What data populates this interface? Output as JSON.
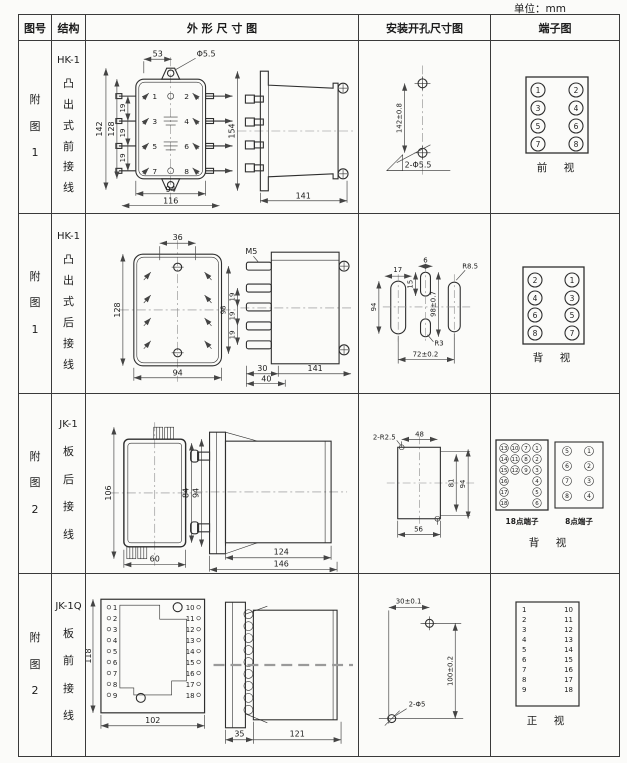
{
  "unit_label": "单位：mm",
  "header": {
    "fig": "图号",
    "struct": "结构",
    "outline": "外 形 尺 寸 图",
    "mount": "安装开孔尺寸图",
    "terminal": "端子图"
  },
  "rows": [
    {
      "fig_no": "附图1",
      "model": "HK-1",
      "structure": "凸出式前接线",
      "front": {
        "d53": "53",
        "dhole": "Φ5.5",
        "d142": "142",
        "d128": "128",
        "p1": "19",
        "p2": "19",
        "p3": "19",
        "d94": "94",
        "d116": "116",
        "t": [
          "1",
          "2",
          "3",
          "4",
          "5",
          "6",
          "7",
          "8"
        ]
      },
      "side": {
        "d154": "154",
        "d141": "141"
      },
      "mount": {
        "dv": "142±0.8",
        "holes": "2-Φ5.5"
      },
      "terminal": {
        "t": [
          "1",
          "2",
          "3",
          "4",
          "5",
          "6",
          "7",
          "8"
        ],
        "view": "前　视"
      }
    },
    {
      "fig_no": "附图1",
      "model": "HK-1",
      "structure": "凸出式后接线",
      "front": {
        "d36": "36",
        "d128": "128",
        "d94": "94"
      },
      "side": {
        "m5": "M5",
        "p1": "19",
        "p2": "19",
        "p3": "19",
        "d98": "98",
        "d30": "30",
        "d40": "40",
        "d141": "141"
      },
      "mount": {
        "d17": "17",
        "d6": "6",
        "d15": "15",
        "d94": "94",
        "dv": "98±0.7",
        "r1": "R8.5",
        "r2": "R3",
        "span": "72±0.2"
      },
      "terminal": {
        "t": [
          "2",
          "1",
          "4",
          "3",
          "6",
          "5",
          "8",
          "7"
        ],
        "view": "背　视"
      }
    },
    {
      "fig_no": "附图2",
      "model": "JK-1",
      "structure": "板后接线",
      "front": {
        "d106": "106",
        "d84": "84",
        "d94": "94",
        "d60": "60"
      },
      "side": {
        "d124": "124",
        "d146": "146"
      },
      "mount": {
        "corner": "2-R2.5",
        "d48": "48",
        "d81": "81",
        "d94": "94",
        "d56": "56"
      },
      "terminal": {
        "t18": [
          "13",
          "10",
          "7",
          "1",
          "14",
          "11",
          "8",
          "2",
          "15",
          "12",
          "9",
          "3",
          "16",
          "4",
          "17",
          "5",
          "18",
          "6"
        ],
        "t18_label": "18点端子",
        "t8": [
          "5",
          "1",
          "6",
          "2",
          "7",
          "3",
          "8",
          "4"
        ],
        "t8_label": "8点端子",
        "view": "背　视"
      }
    },
    {
      "fig_no": "附图2",
      "model": "JK-1Q",
      "structure": "板前接线",
      "front": {
        "d118": "118",
        "d102": "102",
        "left": [
          "1",
          "2",
          "3",
          "4",
          "5",
          "6",
          "7",
          "8",
          "9"
        ],
        "right": [
          "10",
          "11",
          "12",
          "13",
          "14",
          "15",
          "16",
          "17",
          "18"
        ]
      },
      "side": {
        "d35": "35",
        "d121": "121"
      },
      "mount": {
        "d30": "30±0.1",
        "d100": "100±0.2",
        "holes": "2-Φ5"
      },
      "terminal": {
        "left": [
          "1",
          "2",
          "3",
          "4",
          "5",
          "6",
          "7",
          "8",
          "9"
        ],
        "right": [
          "10",
          "11",
          "12",
          "13",
          "14",
          "15",
          "16",
          "17",
          "18"
        ],
        "view": "正　视"
      }
    }
  ]
}
